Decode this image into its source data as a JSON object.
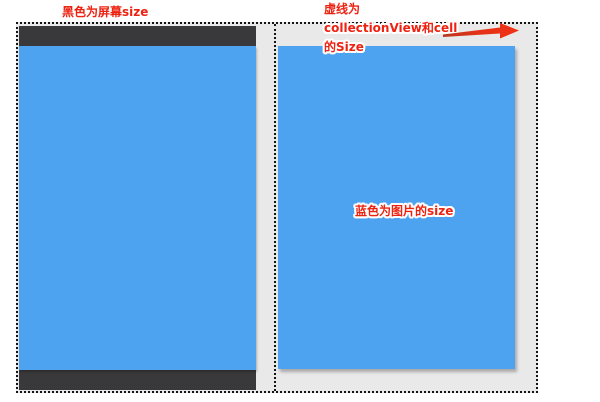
{
  "canvas": {
    "width_px": 600,
    "height_px": 402
  },
  "colors": {
    "canvas_bg": "#ffffff",
    "screen_dark": "#39393b",
    "image_blue": "#4ea3f1",
    "cell_gray": "#e9e9e9",
    "dotted_border": "#141414",
    "annotation_red": "#ee2211",
    "arrow_red": "#e23318"
  },
  "annotations": {
    "screen_label": "黑色为屏幕size",
    "collectionview_label_line1": "虚线为",
    "collectionview_label_line2": "collectionView和cell",
    "collectionview_label_line3": "的Size",
    "image_label": "蓝色为图片的size",
    "arrow_icon": "right-arrow"
  }
}
